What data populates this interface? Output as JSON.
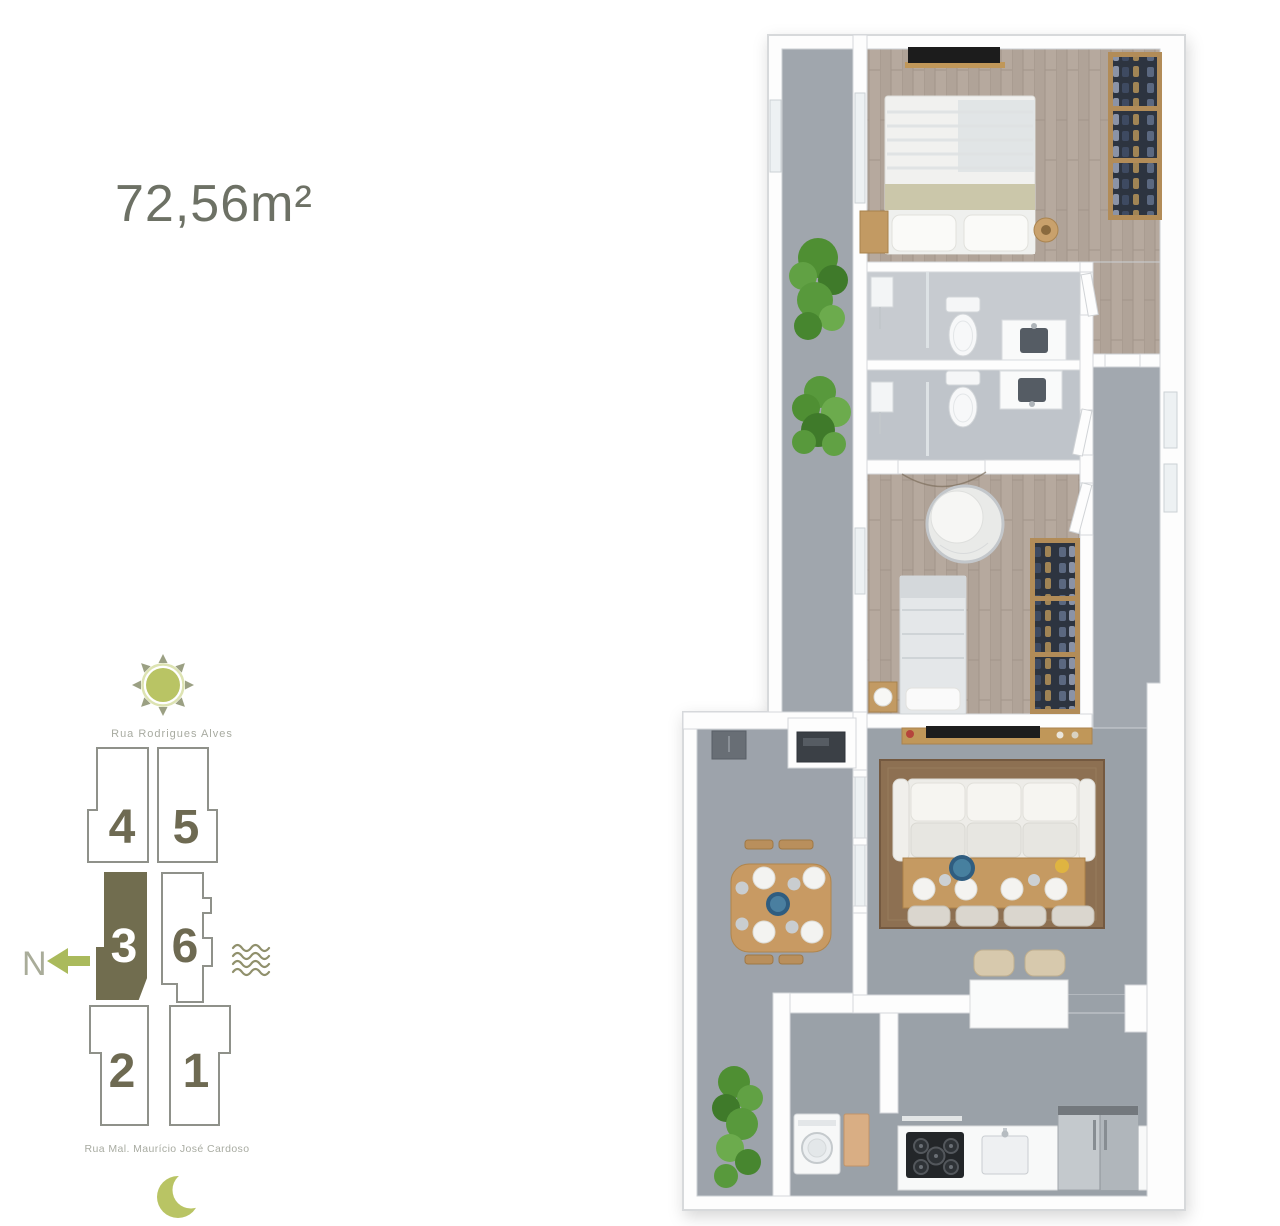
{
  "area_label": "72,56m²",
  "site_plan": {
    "street_top": "Rua Rodrigues Alves",
    "street_bottom": "Rua Mal. Maurício José Cardoso",
    "north_label": "N",
    "units": [
      {
        "label": "4",
        "highlighted": false
      },
      {
        "label": "5",
        "highlighted": false
      },
      {
        "label": "3",
        "highlighted": true
      },
      {
        "label": "6",
        "highlighted": false
      },
      {
        "label": "2",
        "highlighted": false
      },
      {
        "label": "1",
        "highlighted": false
      }
    ],
    "icons": {
      "sun": "sun-icon",
      "moon": "moon-icon",
      "north_arrow": "north-arrow-icon",
      "waves": "waves-icon"
    }
  },
  "floor_plan": {
    "unit_area": "72,56m²",
    "rooms": [
      "side-balcony",
      "master-bedroom",
      "ensuite-bathroom",
      "bathroom-2",
      "bedroom-2",
      "hallway",
      "living-dining",
      "balcony-terrace",
      "kitchen",
      "laundry"
    ]
  },
  "colors": {
    "accent_green": "#b9c464",
    "ray_olive": "#9ba083",
    "unit_highlight": "#716d4f",
    "unit_number": "#6e6a52",
    "unit_outline": "#8f918a",
    "street_text": "#a8aba1",
    "area_text": "#6d7165",
    "north_letter": "#a9ac99",
    "north_arrow": "#aaba5c",
    "waves": "#90906c"
  }
}
